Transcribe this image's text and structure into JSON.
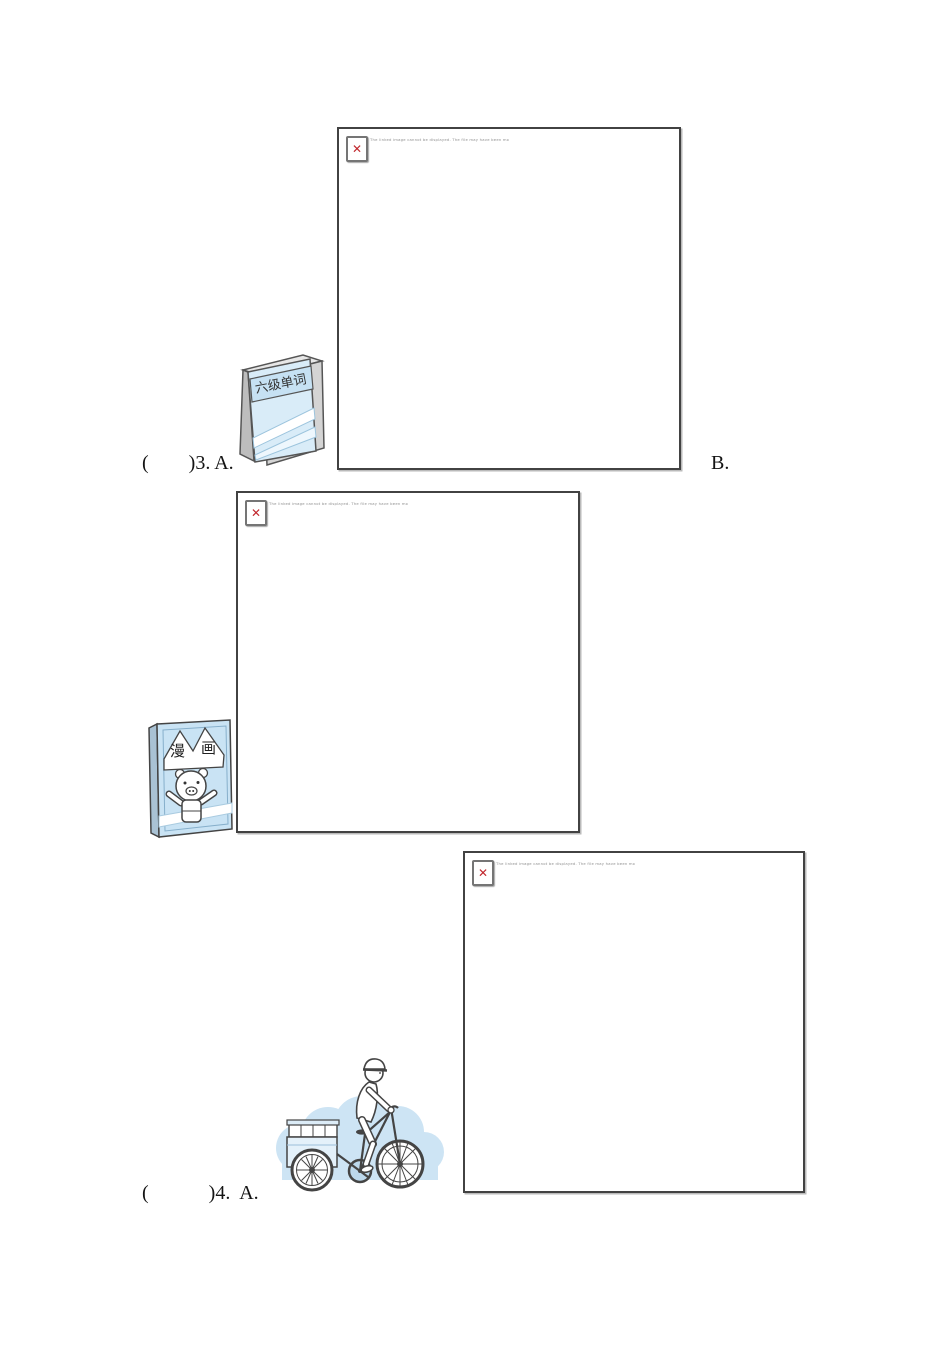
{
  "document": {
    "background": "#ffffff",
    "kind": "listening-test worksheet page"
  },
  "icons": {
    "broken_image_glyph": "✕"
  },
  "broken_images": [
    {
      "caption": "The linked image cannot be displayed. The file may have been moved, renamed, or deleted. Verify that the link points to the correct file and location."
    },
    {
      "caption": "The linked image cannot be displayed. The file may have been moved, renamed, or deleted. Verify that the link points to the correct file and location."
    },
    {
      "caption": "The linked image cannot be displayed. The file may have been moved, renamed, or deleted. Verify that the link points to the correct file and location."
    }
  ],
  "questions": {
    "q3": {
      "label": "(        )3. A.",
      "option_b": "B."
    },
    "q4": {
      "label": "(            )4.  A."
    }
  },
  "illustrations": {
    "vocab_book": {
      "title": "六级单词"
    },
    "comic_book": {
      "char_left": "漫",
      "char_right": "画"
    },
    "postman": {
      "description": "postman riding a mail delivery bicycle"
    }
  },
  "colors": {
    "light_blue": "#cde4f4",
    "cover_blue": "#c9e3f4",
    "book_cover_blue": "#d9ecf8",
    "outline": "#444444",
    "box_border": "#424242",
    "red_x": "#c1272d",
    "caption_gray": "#8f8f8f"
  }
}
